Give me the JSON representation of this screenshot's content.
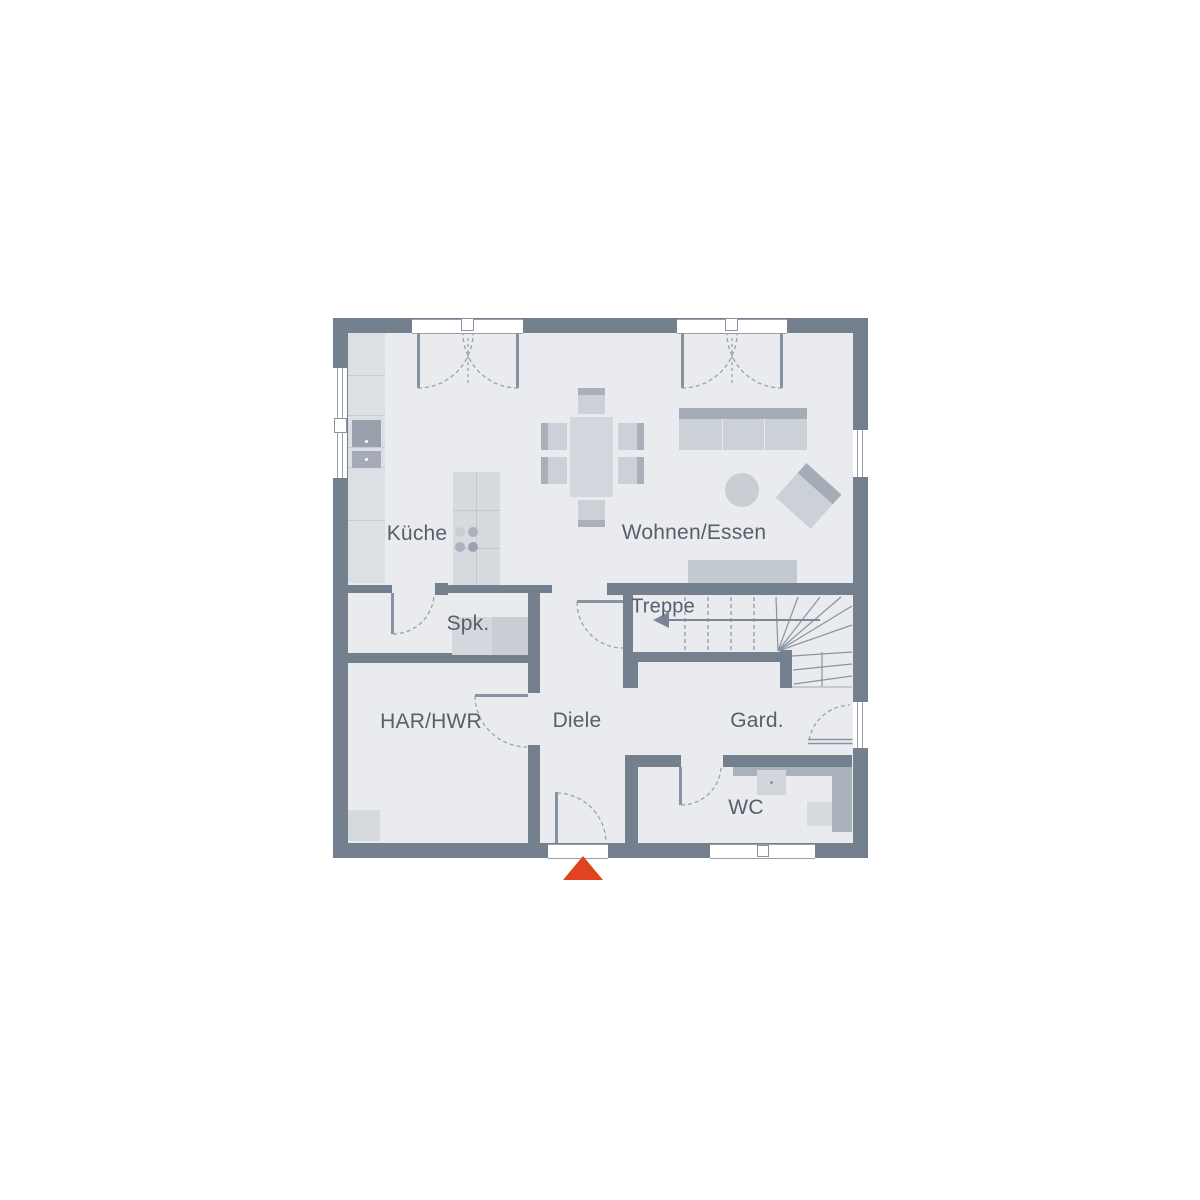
{
  "plan": {
    "type": "floor-plan",
    "rooms": [
      {
        "id": "kueche",
        "label": "Küche"
      },
      {
        "id": "wohnen_essen",
        "label": "Wohnen/Essen"
      },
      {
        "id": "spk",
        "label": "Spk."
      },
      {
        "id": "treppe",
        "label": "Treppe"
      },
      {
        "id": "har_hwr",
        "label": "HAR/HWR"
      },
      {
        "id": "diele",
        "label": "Diele"
      },
      {
        "id": "gard",
        "label": "Gard."
      },
      {
        "id": "wc",
        "label": "WC"
      }
    ],
    "colors": {
      "wall": "#75808e",
      "floor": "#e9ebee",
      "furniture_light": "#dcdfe3",
      "furniture_mid": "#ccd1d8",
      "furniture_dark": "#a4acb7",
      "appliance_dark": "#99a1ad",
      "label_text": "#575f6b",
      "entrance_marker": "#e0431f",
      "background": "#ffffff"
    },
    "icons": {
      "entrance_marker": "triangle-up",
      "stair_direction": "arrow-left"
    }
  }
}
